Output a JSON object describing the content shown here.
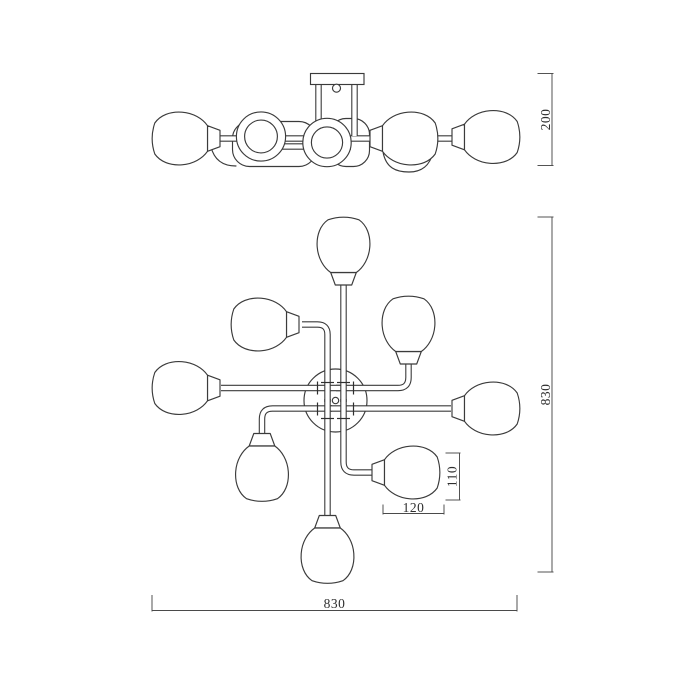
{
  "meta": {
    "drawing_type": "technical line drawing",
    "subject": "8-light ceiling chandelier, front elevation (top) and plan view (bottom)",
    "background_color": "#ffffff",
    "line_color": "#3b3b3b",
    "text_color": "#2e2e2e"
  },
  "dimensions": {
    "fixture_height": "200",
    "overall_depth": "830",
    "overall_width": "830",
    "shade_height": "110",
    "shade_width": "120"
  }
}
